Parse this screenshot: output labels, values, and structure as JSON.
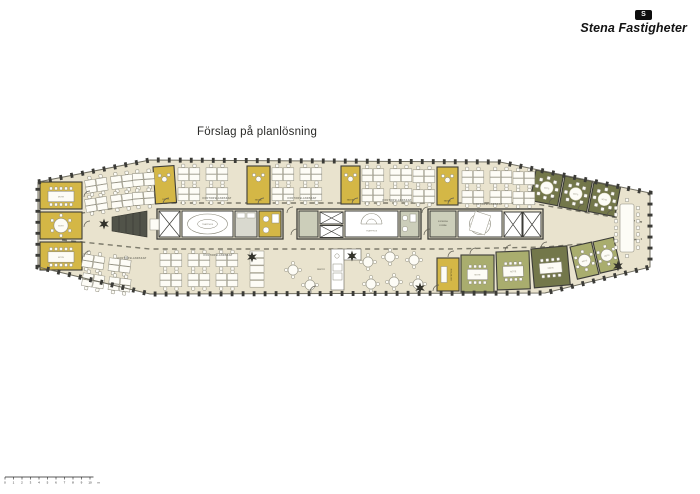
{
  "title": "Förslag på planlösning",
  "logo": {
    "company": "Stena Fastigheter",
    "mark_letter": "S"
  },
  "plan": {
    "colors": {
      "floor": "#e9e3ce",
      "wall": "#3c3c38",
      "yellow": "#d4b746",
      "olive": "#73774a",
      "green": "#a9ad6e",
      "core_gray": "#ccceba",
      "furniture_white": "#fdfcf6",
      "dark_item": "#515349"
    },
    "labels": {
      "mote": "MÖTE",
      "samtal": "SAMTAL",
      "trapphus": "TRAPPHUS",
      "kontorslandskap": "KONTORSLANDSKAP",
      "reception": "RECEPTION",
      "pentry": "PENTRY",
      "kopiering": "KOPIERING",
      "forrad": "FÖRRÅD"
    },
    "rooms": [
      {
        "id": "mote-left-1",
        "label_key": "mote",
        "color": "yellow"
      },
      {
        "id": "mote-left-2",
        "label_key": "mote",
        "color": "yellow"
      },
      {
        "id": "mote-left-3",
        "label_key": "mote",
        "color": "yellow"
      },
      {
        "id": "samtal-1",
        "label_key": "samtal",
        "color": "yellow"
      },
      {
        "id": "samtal-2",
        "label_key": "samtal",
        "color": "yellow"
      },
      {
        "id": "samtal-3",
        "label_key": "samtal",
        "color": "yellow"
      },
      {
        "id": "samtal-4",
        "label_key": "samtal",
        "color": "yellow"
      },
      {
        "id": "mote-ne-1",
        "label_key": "mote",
        "color": "olive"
      },
      {
        "id": "mote-ne-2",
        "label_key": "mote",
        "color": "olive"
      },
      {
        "id": "mote-ne-3",
        "label_key": "mote",
        "color": "olive"
      },
      {
        "id": "reception",
        "label_key": "reception",
        "color": "yellow"
      },
      {
        "id": "mote-se-1",
        "label_key": "mote",
        "color": "green"
      },
      {
        "id": "mote-se-2",
        "label_key": "mote",
        "color": "green"
      },
      {
        "id": "mote-se-3",
        "label_key": "mote",
        "color": "olive"
      },
      {
        "id": "mote-se-4",
        "label_key": "mote",
        "color": "green"
      },
      {
        "id": "mote-se-5",
        "label_key": "mote",
        "color": "green"
      }
    ]
  },
  "scale_bar": {
    "ticks": [
      "0",
      "1",
      "2",
      "3",
      "4",
      "5",
      "6",
      "7",
      "8",
      "9",
      "10"
    ],
    "unit": "m"
  }
}
